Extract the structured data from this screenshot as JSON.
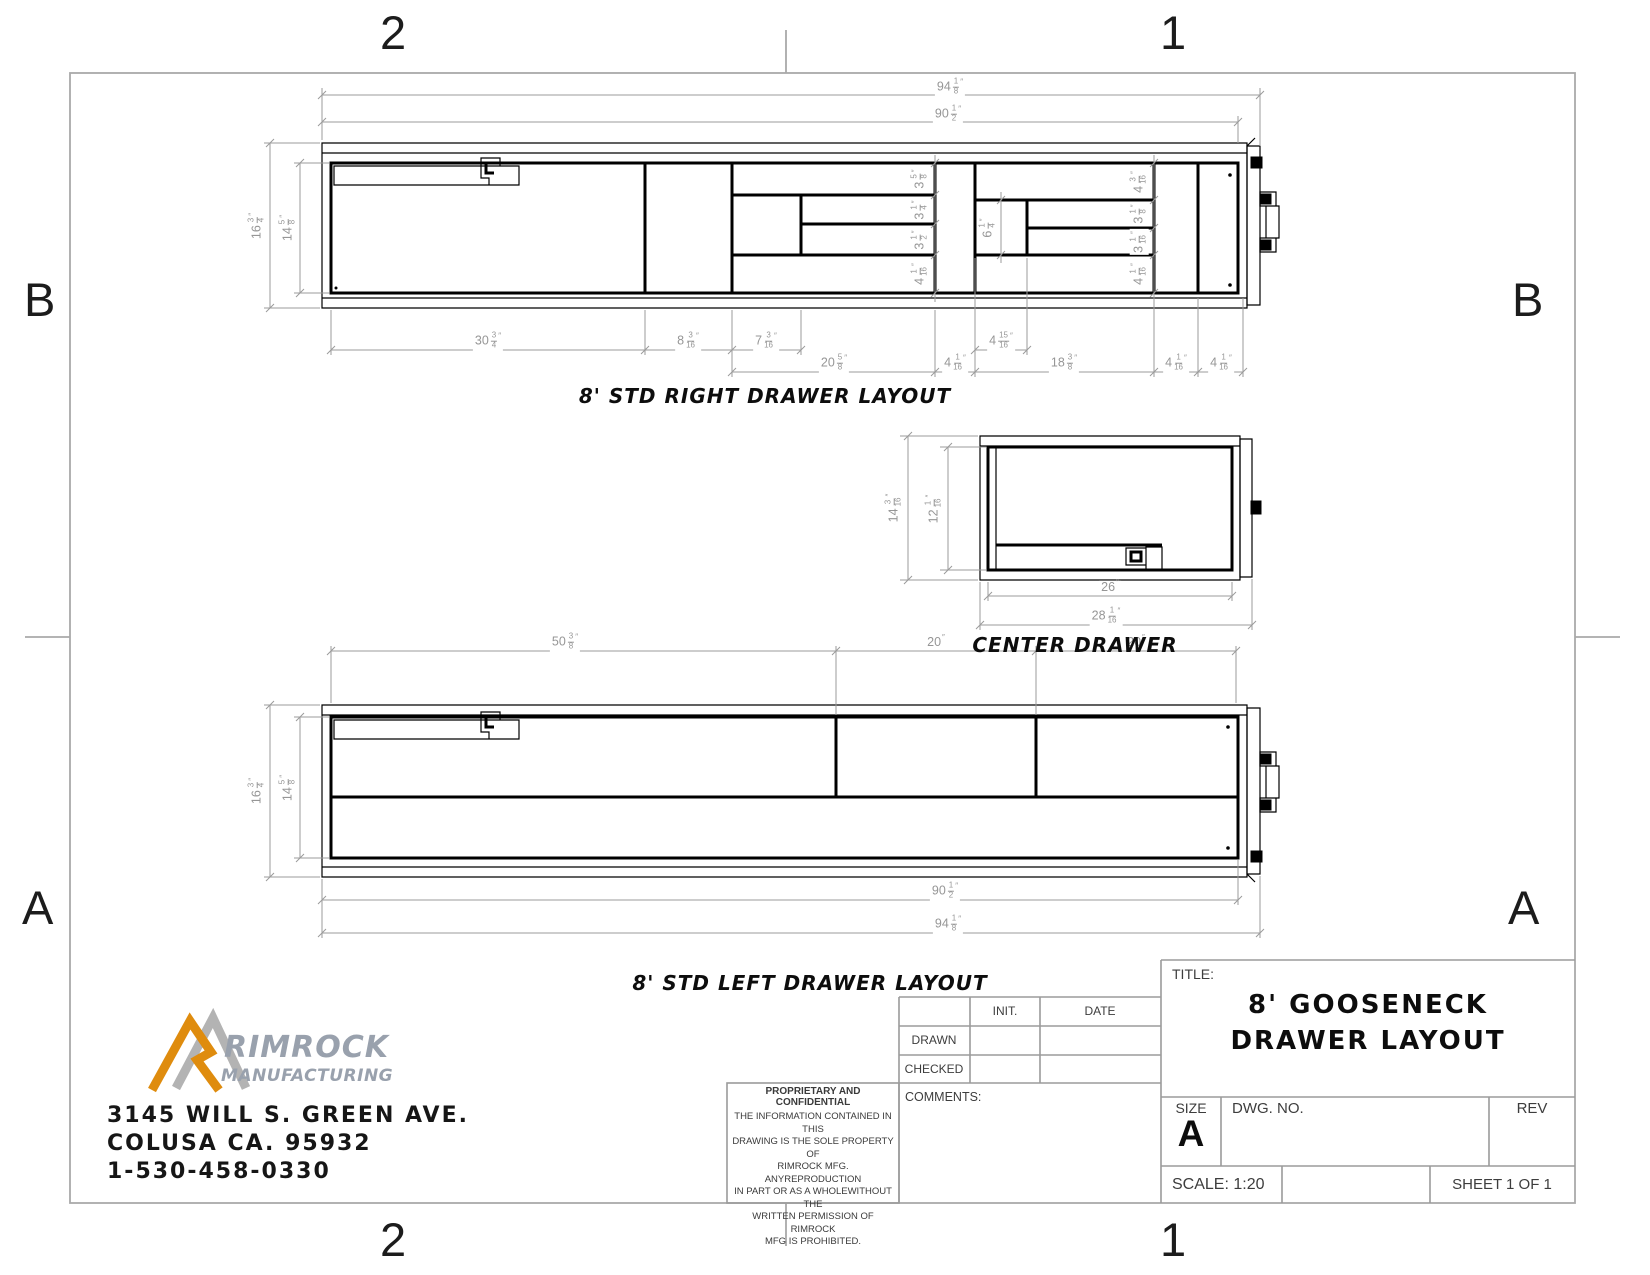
{
  "page": {
    "background": "#ffffff",
    "geometry_color": "#000000",
    "dimension_color": "#9b9b9b",
    "frame_color": "#a9a9a9",
    "scale_note": "1:20"
  },
  "zones": {
    "top_left": "2",
    "top_right": "1",
    "left_upper": "B",
    "left_lower": "A",
    "right_upper": "B",
    "right_lower": "A",
    "bottom_left": "2",
    "bottom_right": "1"
  },
  "drawings": {
    "right": {
      "title": "8' STD RIGHT DRAWER LAYOUT",
      "overall_w": "94 1/8\"",
      "inner_w": "90 1/2\"",
      "overall_h": "16 3/4\"",
      "inner_h": "14 5/8\"",
      "row1": [
        "30 3/4\"",
        "8 3/16\"",
        "7 3/16\"",
        "4 15/16\""
      ],
      "row2": [
        "20 5/8\"",
        "4 1/16\"",
        "18 3/8\"",
        "4 1/16\"",
        "4 1/16\""
      ],
      "stack_mid": [
        "3 5/8\"",
        "3 1/4\"",
        "3 1/2\"",
        "4 1/16\""
      ],
      "cell_h": "6 1/4\"",
      "stack_right": [
        "4 3/16\"",
        "3 1/8\"",
        "3 1/16\"",
        "4 1/16\""
      ]
    },
    "center": {
      "title": "CENTER DRAWER",
      "overall_h": "14 3/16\"",
      "inner_h": "12 1/16\"",
      "inner_w": "26\"",
      "overall_w": "28 1/16\""
    },
    "left": {
      "title": "8' STD LEFT DRAWER LAYOUT",
      "row_top": [
        "50 3/8\"",
        "20\"",
        "20\""
      ],
      "overall_h": "16 3/4\"",
      "inner_h": "14 5/8\"",
      "inner_w": "90 1/2\"",
      "overall_w": "94 1/8\""
    }
  },
  "company": {
    "name": "RIMROCK",
    "name2": "MANUFACTURING",
    "address1": "3145 WILL S. GREEN AVE.",
    "address2": "COLUSA CA. 95932",
    "phone": "1-530-458-0330",
    "logo_orange": "#df8c0e",
    "logo_gray": "#b3b3b3",
    "logo_text_color": "#99a1ad"
  },
  "title_block": {
    "title_label": "TITLE:",
    "title_line1": "8' GOOSENECK",
    "title_line2": "DRAWER LAYOUT",
    "size_label": "SIZE",
    "size_value": "A",
    "dwg_label": "DWG.  NO.",
    "rev_label": "REV",
    "scale_label": "SCALE: 1:20",
    "sheet_label": "SHEET 1 OF 1",
    "init_col": "INIT.",
    "date_col": "DATE",
    "drawn_row": "DRAWN",
    "checked_row": "CHECKED",
    "comments_label": "COMMENTS:",
    "prop_heading": "PROPRIETARY AND CONFIDENTIAL",
    "prop_lines": [
      "THE INFORMATION CONTAINED IN THIS",
      "DRAWING IS THE SOLE PROPERTY OF",
      "RIMROCK MFG.  ANYREPRODUCTION",
      "IN PART OR AS A WHOLEWITHOUT THE",
      "WRITTEN PERMISSION OF RIMROCK",
      "MFG IS PROHIBITED."
    ]
  }
}
